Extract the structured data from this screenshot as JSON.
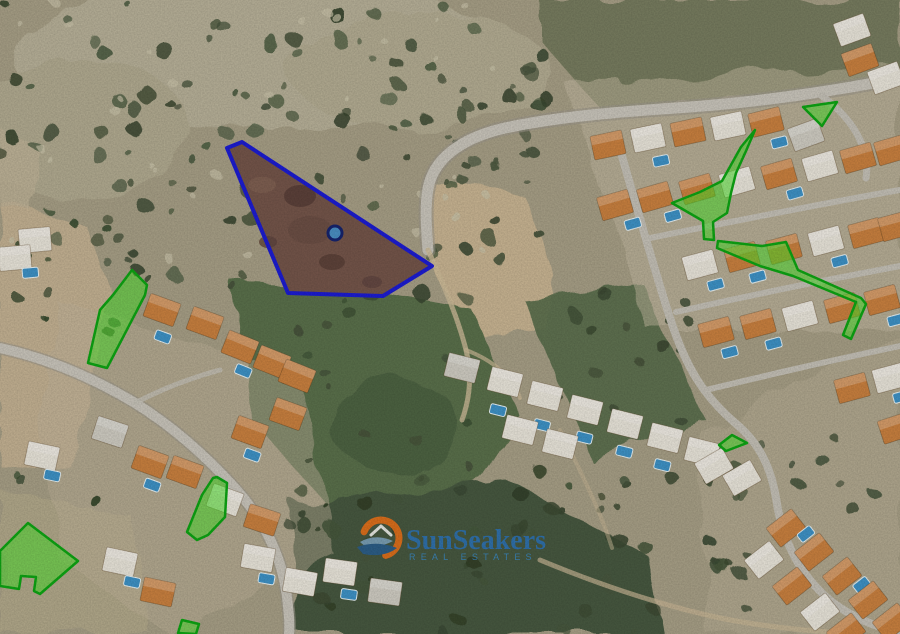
{
  "watermark": {
    "brand": "SunSeakers",
    "tagline": "REAL ESTATES"
  },
  "map": {
    "description": "Satellite aerial view of a hillside residential area with real-estate plot overlays",
    "colors": {
      "main_plot_outline": "#1c1cd2",
      "main_plot_ground": "#7a5a44",
      "main_plot_fill": "rgba(45,25,160,0.07)",
      "marker_fill": "#4a8fc3",
      "marker_stroke": "#16246e",
      "highlight_fill": "rgba(74,226,42,0.55)",
      "highlight_stroke": "#0da513",
      "watermark_text": "#2e74b5",
      "watermark_accent": "#e8711a"
    },
    "main_plot": {
      "name": "main-plot-outline",
      "points": [
        [
          227,
          148
        ],
        [
          242,
          142
        ],
        [
          432,
          266
        ],
        [
          383,
          296
        ],
        [
          288,
          293
        ]
      ],
      "marker": {
        "x": 335,
        "y": 233,
        "r": 7
      }
    },
    "highlight_plots": [
      {
        "name": "highlight-plot-1",
        "points": [
          [
            803,
            107
          ],
          [
            837,
            102
          ],
          [
            822,
            126
          ]
        ]
      },
      {
        "name": "highlight-plot-2",
        "points": [
          [
            755,
            130
          ],
          [
            746,
            151
          ],
          [
            736,
            173
          ],
          [
            731,
            193
          ],
          [
            727,
            213
          ],
          [
            713,
            222
          ],
          [
            714,
            240
          ],
          [
            704,
            239
          ],
          [
            703,
            221
          ],
          [
            672,
            203
          ],
          [
            700,
            192
          ],
          [
            722,
            181
          ],
          [
            741,
            147
          ]
        ]
      },
      {
        "name": "highlight-plot-3",
        "points": [
          [
            718,
            241
          ],
          [
            762,
            246
          ],
          [
            786,
            242
          ],
          [
            798,
            270
          ],
          [
            861,
            298
          ],
          [
            866,
            304
          ],
          [
            851,
            339
          ],
          [
            843,
            335
          ],
          [
            856,
            302
          ],
          [
            793,
            276
          ],
          [
            760,
            266
          ],
          [
            717,
            248
          ]
        ]
      },
      {
        "name": "highlight-plot-4",
        "points": [
          [
            132,
            270
          ],
          [
            147,
            285
          ],
          [
            145,
            295
          ],
          [
            107,
            368
          ],
          [
            88,
            363
          ],
          [
            100,
            310
          ],
          [
            113,
            295
          ]
        ]
      },
      {
        "name": "highlight-plot-5",
        "points": [
          [
            719,
            445
          ],
          [
            732,
            435
          ],
          [
            747,
            443
          ],
          [
            726,
            451
          ]
        ]
      },
      {
        "name": "highlight-plot-6",
        "points": [
          [
            28,
            523
          ],
          [
            78,
            561
          ],
          [
            40,
            594
          ],
          [
            34,
            591
          ],
          [
            36,
            577
          ],
          [
            21,
            576
          ],
          [
            19,
            589
          ],
          [
            0,
            586
          ],
          [
            0,
            551
          ]
        ]
      },
      {
        "name": "highlight-plot-7",
        "points": [
          [
            217,
            477
          ],
          [
            227,
            483
          ],
          [
            225,
            517
          ],
          [
            208,
            535
          ],
          [
            197,
            540
          ],
          [
            187,
            532
          ],
          [
            202,
            495
          ],
          [
            213,
            478
          ]
        ]
      },
      {
        "name": "highlight-plot-8",
        "points": [
          [
            182,
            620
          ],
          [
            199,
            624
          ],
          [
            196,
            634
          ],
          [
            178,
            633
          ]
        ]
      }
    ]
  }
}
